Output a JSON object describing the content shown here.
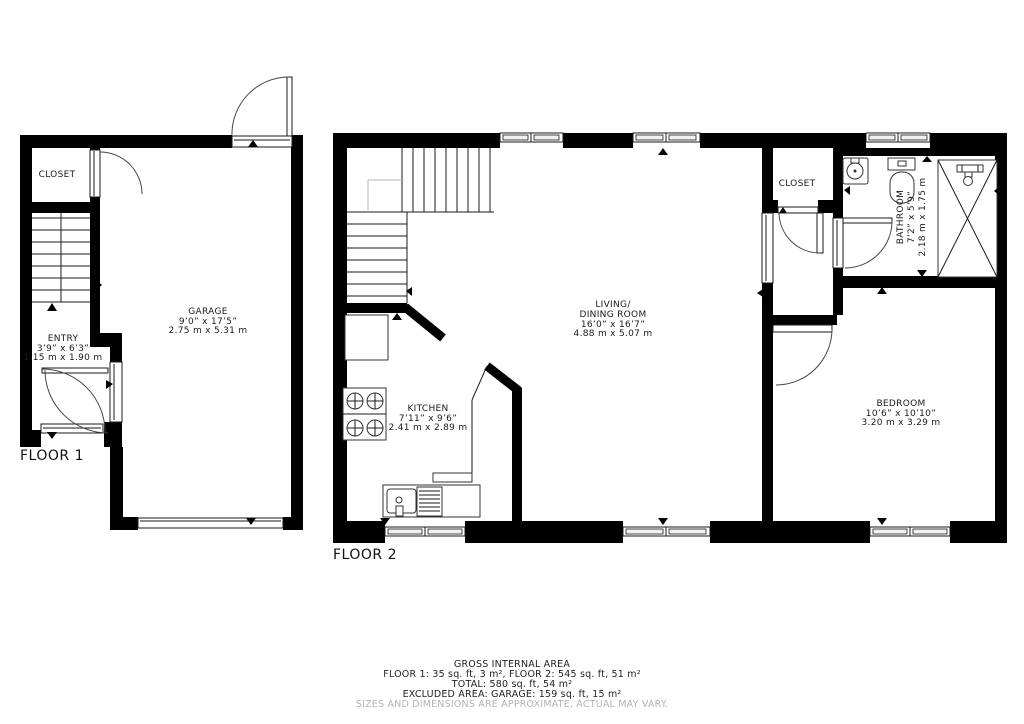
{
  "floor1": {
    "label": "FLOOR 1",
    "closet": {
      "name": "CLOSET"
    },
    "entry": {
      "name": "ENTRY",
      "dim_ft": "3’9” x 6’3”",
      "dim_m": "1.15 m x 1.90 m"
    },
    "garage": {
      "name": "GARAGE",
      "dim_ft": "9’0” x 17’5”",
      "dim_m": "2.75 m x 5.31 m"
    }
  },
  "floor2": {
    "label": "FLOOR 2",
    "kitchen": {
      "name": "KITCHEN",
      "dim_ft": "7’11” x 9’6”",
      "dim_m": "2.41 m x 2.89 m"
    },
    "living": {
      "name1": "LIVING/",
      "name2": "DINING ROOM",
      "dim_ft": "16’0” x 16’7”",
      "dim_m": "4.88 m x 5.07 m"
    },
    "closet": {
      "name": "CLOSET"
    },
    "bathroom": {
      "name": "BATHROOM",
      "dim_ft": "7’2” x 5’9”",
      "dim_m": "2.18 m x 1.75 m"
    },
    "bedroom": {
      "name": "BEDROOM",
      "dim_ft": "10’6” x 10’10”",
      "dim_m": "3.20 m x 3.29 m"
    }
  },
  "footer": {
    "title": "GROSS INTERNAL AREA",
    "floors": "FLOOR 1: 35 sq. ft, 3 m², FLOOR 2: 545 sq. ft, 51 m²",
    "total": "TOTAL: 580 sq. ft, 54 m²",
    "excluded": "EXCLUDED AREA: GARAGE: 159 sq. ft, 15 m²",
    "disclaimer": "SIZES AND DIMENSIONS ARE APPROXIMATE, ACTUAL MAY VARY."
  },
  "colors": {
    "wall": "#000000",
    "background": "#ffffff",
    "disclaimer": "#b3b3b3"
  }
}
